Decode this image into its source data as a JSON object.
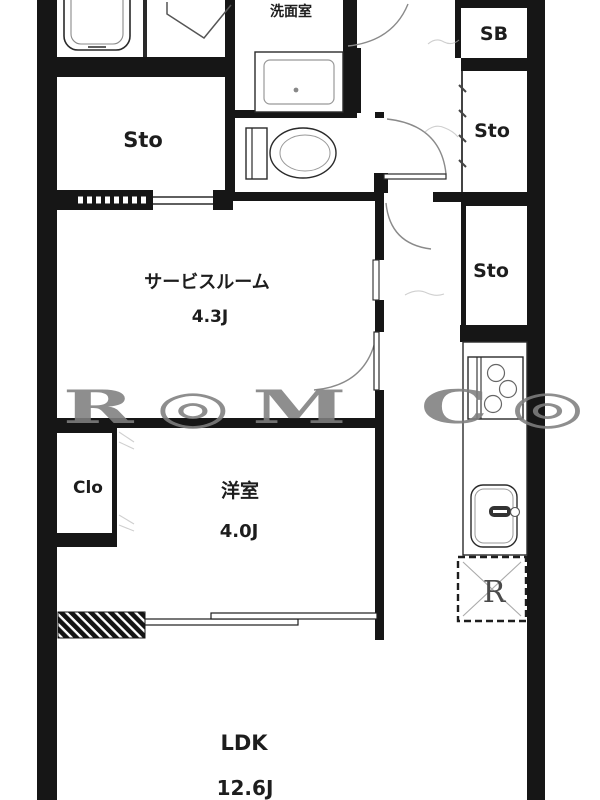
{
  "floorplan": {
    "rooms": {
      "washroom": {
        "label": "洗面室"
      },
      "storage_top_left": {
        "label": "Sto"
      },
      "shoe_box": {
        "label": "SB"
      },
      "storage_right_1": {
        "label": "Sto"
      },
      "storage_right_2": {
        "label": "Sto"
      },
      "service_room": {
        "label": "サービスルーム",
        "size": "4.3J"
      },
      "closet": {
        "label": "Clo"
      },
      "western_room": {
        "label": "洋室",
        "size": "4.0J"
      },
      "ldk": {
        "label": "LDK",
        "size": "12.6J"
      },
      "refrigerator_space": {
        "label": "R"
      }
    },
    "watermark": "R◎M C◎◎",
    "colors": {
      "wall": "#161616",
      "fixture_line": "#2a2a2a",
      "light_line": "#999999",
      "door_arc": "#8a8a8a",
      "watermark": "#7f7f7f"
    }
  }
}
